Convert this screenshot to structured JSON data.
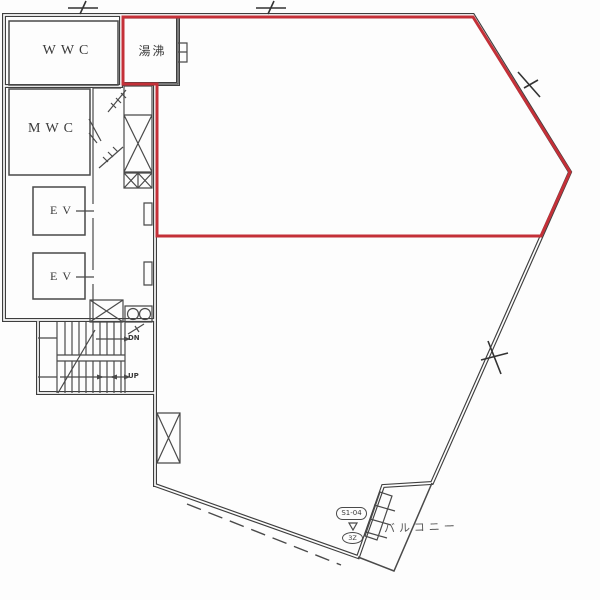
{
  "colors": {
    "wall": "#3e3e3e",
    "thin": "#4a4a4a",
    "highlight": "#c43038",
    "label": "#3a3a3a",
    "muted": "#575757"
  },
  "rooms": {
    "wwc": "WWC",
    "mwc": "MWC",
    "ev_upper": "EV",
    "ev_lower": "EV",
    "kitchenette": "湯沸"
  },
  "stairs": {
    "down": "DN",
    "up": "UP"
  },
  "balcony": {
    "label": "バルコニー"
  },
  "marker": {
    "code": "S1-04",
    "sub": "3Z"
  }
}
